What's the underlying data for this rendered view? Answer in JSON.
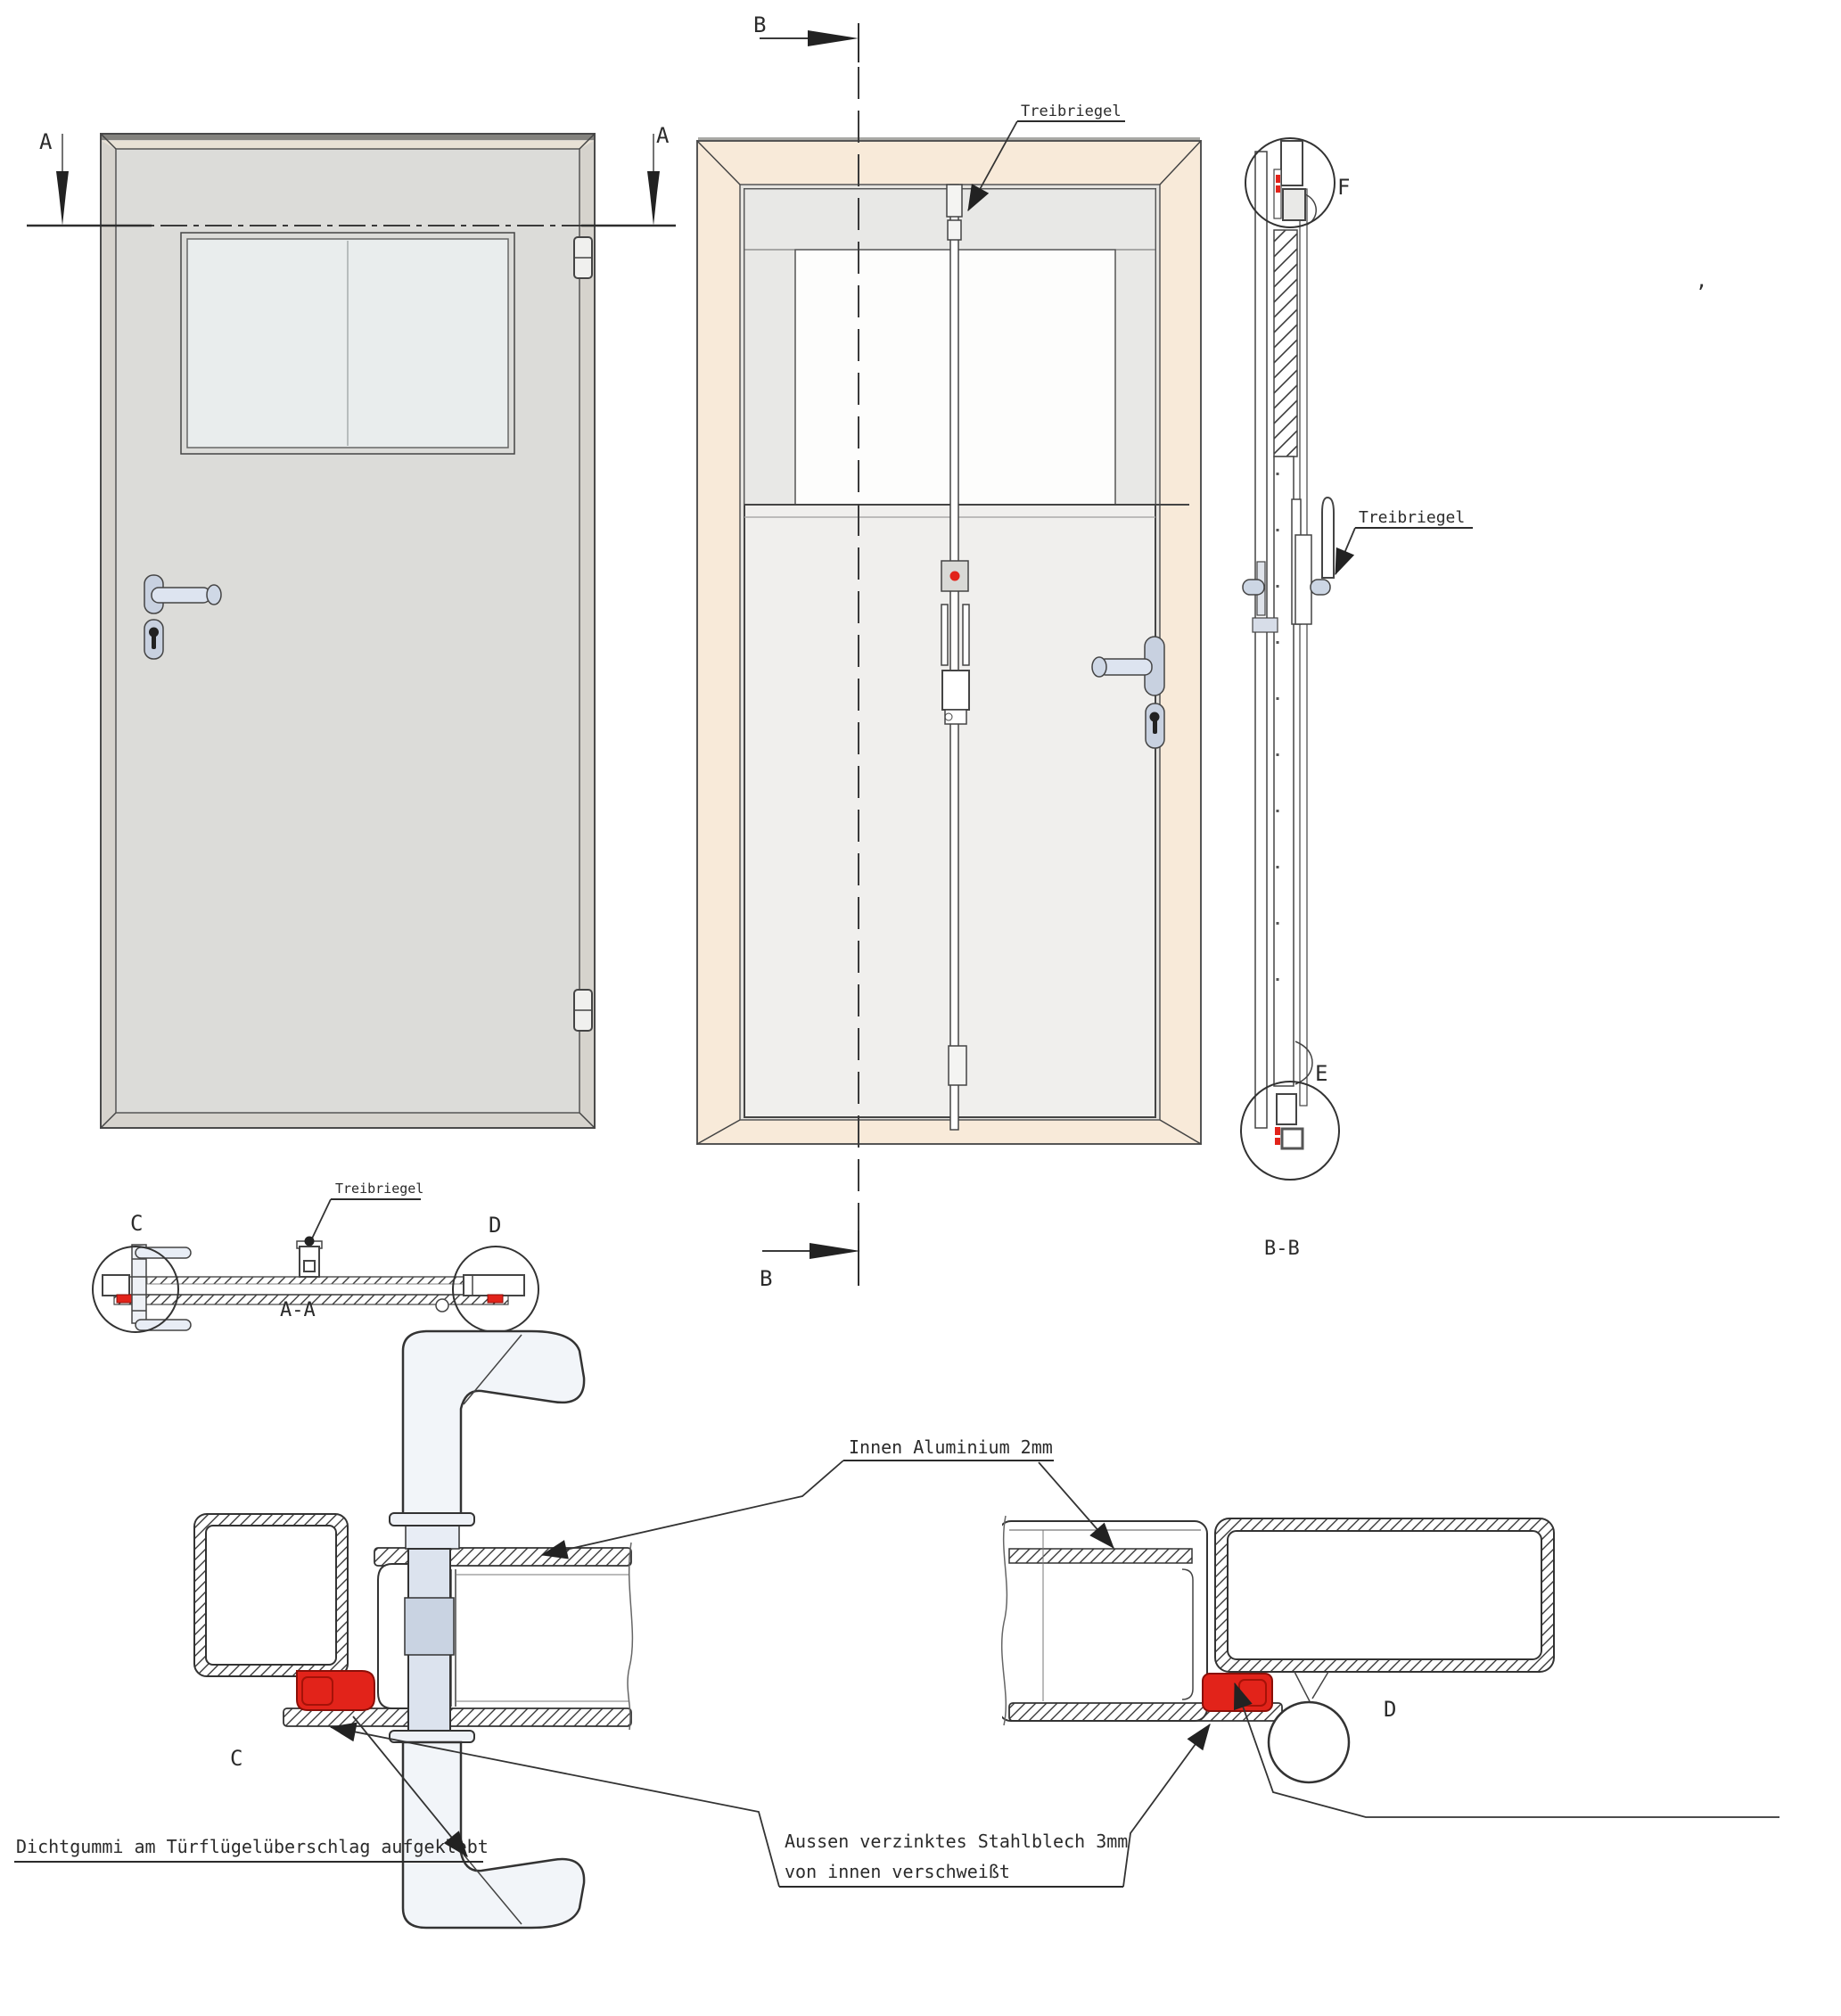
{
  "drawing": {
    "views": {
      "front": {
        "marker_left": "A",
        "marker_right": "A"
      },
      "inside": {
        "marker_top": "B",
        "marker_bottom": "B",
        "bolt_label": "Treibriegel"
      },
      "side_section": {
        "title": "B-B",
        "detail_top": "F",
        "detail_bottom": "E",
        "bolt_label": "Treibriegel"
      },
      "horizontal_section": {
        "title": "A-A",
        "detail_left": "C",
        "detail_right": "D",
        "bolt_label": "Treibriegel"
      },
      "detail_c": {
        "label": "C"
      },
      "detail_d": {
        "label": "D"
      }
    },
    "annotations": {
      "inner_sheet": "Innen Aluminium 2mm",
      "outer_sheet_line1": "Aussen verzinktes Stahlblech 3mm",
      "outer_sheet_line2": "von innen verschweißt",
      "seal": "Dichtgummi am Türflügelüberschlag aufgeklebt"
    },
    "artifact_mark": ",",
    "colors": {
      "seal_red": "#e2231a",
      "frame_cream": "#f8ead9",
      "frame_gray": "#d6d3cd",
      "leaf_gray": "#dcdcd9",
      "hardware_blue": "#ccd6e4",
      "line_dark": "#333333"
    }
  }
}
